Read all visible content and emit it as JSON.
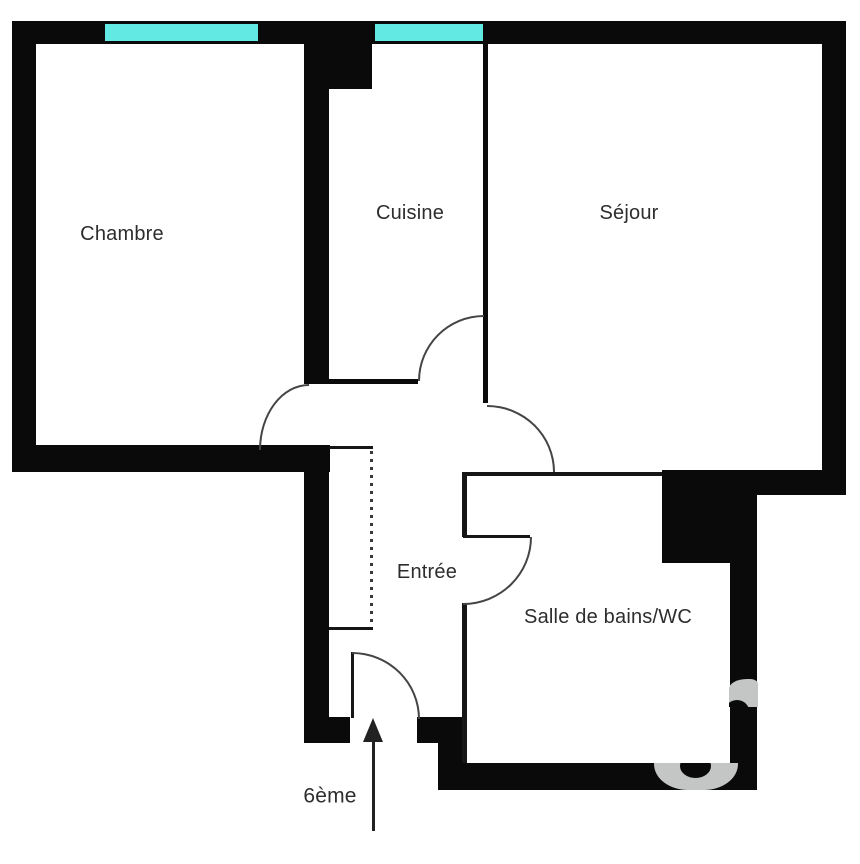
{
  "floorplan": {
    "title": "apartment-floor-plan",
    "rooms": {
      "chambre": {
        "label": "Chambre"
      },
      "cuisine": {
        "label": "Cuisine"
      },
      "sejour": {
        "label": "Séjour"
      },
      "entree": {
        "label": "Entrée"
      },
      "bains": {
        "label": "Salle de bains/WC"
      }
    },
    "floor": {
      "label": "6ème"
    },
    "windows": {
      "count": 2
    },
    "colors": {
      "wall": "#0a0a0a",
      "window": "#62e9e4",
      "door_arc": "#454545",
      "text": "#2d2d2d",
      "watermark": "#c4c6c5",
      "background": "#ffffff"
    }
  }
}
